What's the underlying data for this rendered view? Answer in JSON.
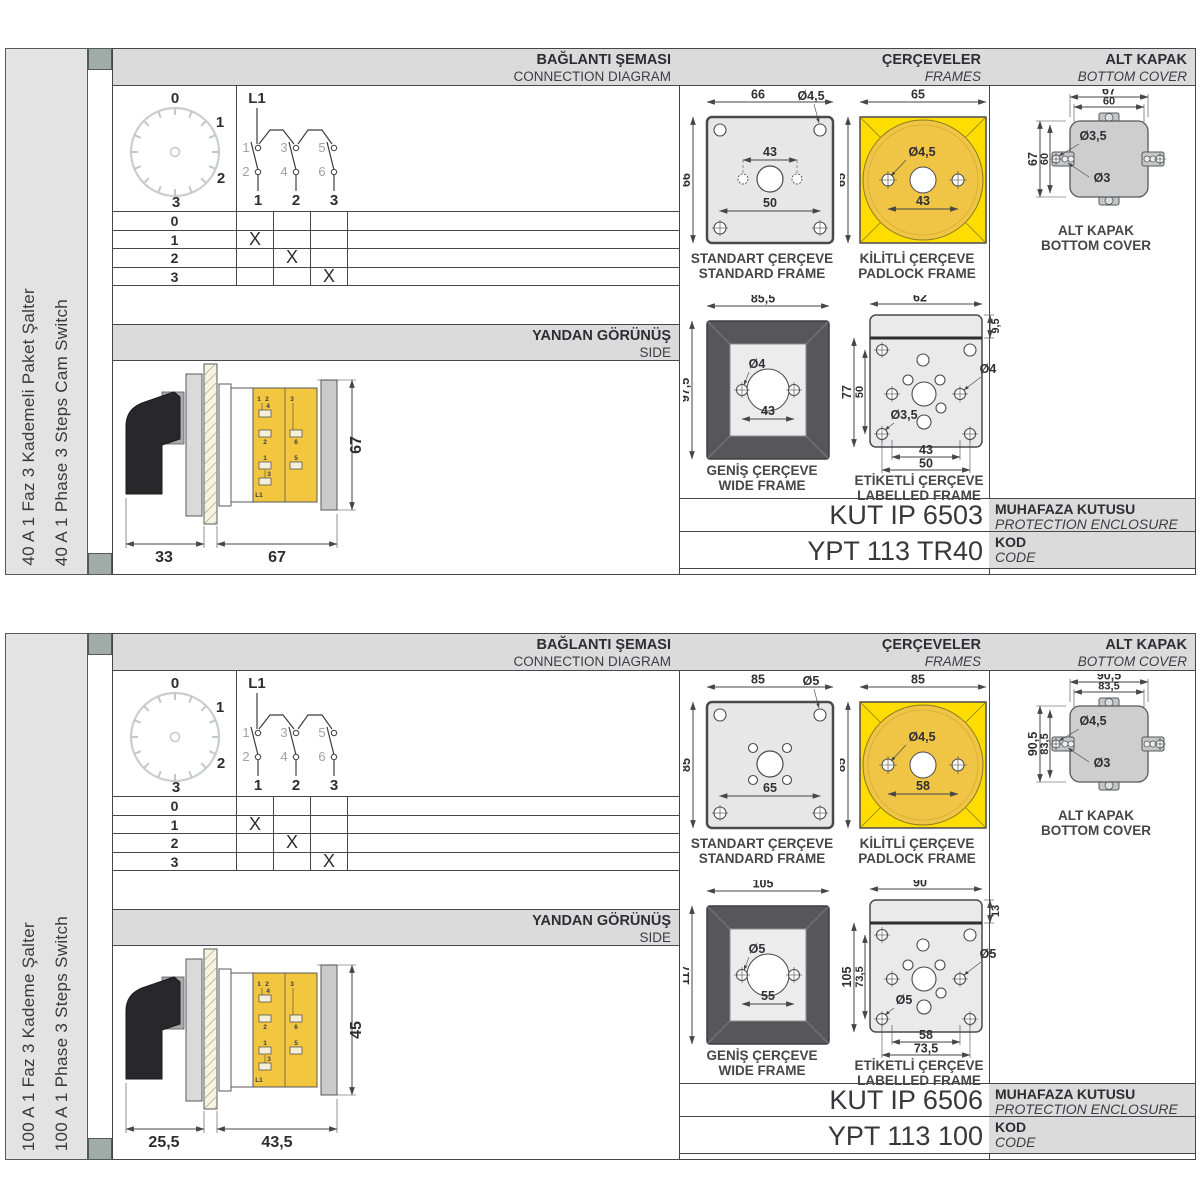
{
  "shared": {
    "headers": {
      "connection_tr": "BAĞLANTI ŞEMASI",
      "connection_en": "CONNECTION DIAGRAM",
      "frames_tr": "ÇERÇEVELER",
      "frames_en": "FRAMES",
      "cover_tr": "ALT KAPAK",
      "cover_en": "BOTTOM COVER",
      "side_tr": "YANDAN GÖRÜNÜŞ",
      "side_en": "SIDE"
    },
    "captions": {
      "standard_tr": "STANDART ÇERÇEVE",
      "standard_en": "STANDARD FRAME",
      "padlock_tr": "KİLİTLİ ÇERÇEVE",
      "padlock_en": "PADLOCK FRAME",
      "wide_tr": "GENİŞ ÇERÇEVE",
      "wide_en": "WIDE FRAME",
      "labelled_tr": "ETİKETLİ ÇERÇEVE",
      "labelled_en": "LABELLED FRAME",
      "cover_tr": "ALT KAPAK",
      "cover_en": "BOTTOM COVER",
      "enclosure_tr": "MUHAFAZA KUTUSU",
      "enclosure_en": "PROTECTION ENCLOSURE",
      "code_tr": "KOD",
      "code_en": "CODE"
    },
    "dial": [
      "0",
      "1",
      "2",
      "3"
    ],
    "contact": {
      "feed": "L1",
      "top": [
        "1",
        "3",
        "5"
      ],
      "bottom": [
        "2",
        "4",
        "6"
      ],
      "out": [
        "1",
        "2",
        "3"
      ]
    },
    "table": {
      "rows": [
        {
          "label": "0",
          "marks": [
            "",
            "",
            ""
          ]
        },
        {
          "label": "1",
          "marks": [
            "X",
            "",
            ""
          ]
        },
        {
          "label": "2",
          "marks": [
            "",
            "X",
            ""
          ]
        },
        {
          "label": "3",
          "marks": [
            "",
            "",
            "X"
          ]
        }
      ]
    },
    "side_terminals": [
      "1",
      "2",
      "4",
      "2",
      "1",
      "3",
      "L1",
      "3",
      "6",
      "5"
    ],
    "colors": {
      "frame_yellow": "#FFDD00",
      "circle_yellow": "#F0C545",
      "panel_gray": "#DBDBDB",
      "wide_frame_dark": "#57575B",
      "binder_clip": "#9FACA8"
    }
  },
  "blocks": [
    {
      "title_tr": "40 A 1 Faz 3 Kademeli Paket Şalter",
      "title_en": "40 A 1 Phase 3 Steps Cam Switch",
      "standard_frame": {
        "width": "66",
        "height": "66",
        "hole": "Ø4,5",
        "dim_inner": "43",
        "dim_bottom": "50"
      },
      "padlock_frame": {
        "width": "65",
        "height": "65",
        "hole": "Ø4,5",
        "dim_inner": "43"
      },
      "wide_frame": {
        "width": "85,5",
        "height": "97,5",
        "hole": "Ø4",
        "dim_inner": "43"
      },
      "labelled_frame": {
        "width": "62",
        "strip": "9,5",
        "height": "77",
        "height_inner": "50",
        "hole_side": "Ø4",
        "hole_corner": "Ø3,5",
        "dim_inner": "43",
        "dim_bottom": "50"
      },
      "bottom_cover": {
        "width": "67",
        "width_inner": "60",
        "height": "67",
        "height_inner": "60",
        "hole_a": "Ø3,5",
        "hole_b": "Ø3"
      },
      "side_view": {
        "handle": "33",
        "body": "67",
        "height": "67"
      },
      "enclosure_code": "KUT IP 6503",
      "product_code": "YPT 113 TR40"
    },
    {
      "title_tr": "100 A 1 Faz 3 Kademe Şalter",
      "title_en": "100 A 1 Phase 3 Steps Switch",
      "standard_frame": {
        "width": "85",
        "height": "85",
        "hole": "Ø5",
        "dim_bottom": "65"
      },
      "padlock_frame": {
        "width": "85",
        "height": "85",
        "hole": "Ø4,5",
        "dim_inner": "58"
      },
      "wide_frame": {
        "width": "105",
        "height": "117",
        "hole": "Ø5",
        "dim_inner": "55"
      },
      "labelled_frame": {
        "width": "90",
        "strip": "13",
        "height": "105",
        "height_inner": "73,5",
        "hole_side": "Ø5",
        "hole_corner": "Ø5",
        "dim_inner": "58",
        "dim_bottom": "73,5"
      },
      "bottom_cover": {
        "width": "90,5",
        "width_inner": "83,5",
        "height": "90,5",
        "height_inner": "83,5",
        "hole_a": "Ø4,5",
        "hole_b": "Ø3"
      },
      "side_view": {
        "handle": "25,5",
        "body": "43,5",
        "height": "45"
      },
      "enclosure_code": "KUT IP 6506",
      "product_code": "YPT 113 100"
    }
  ]
}
